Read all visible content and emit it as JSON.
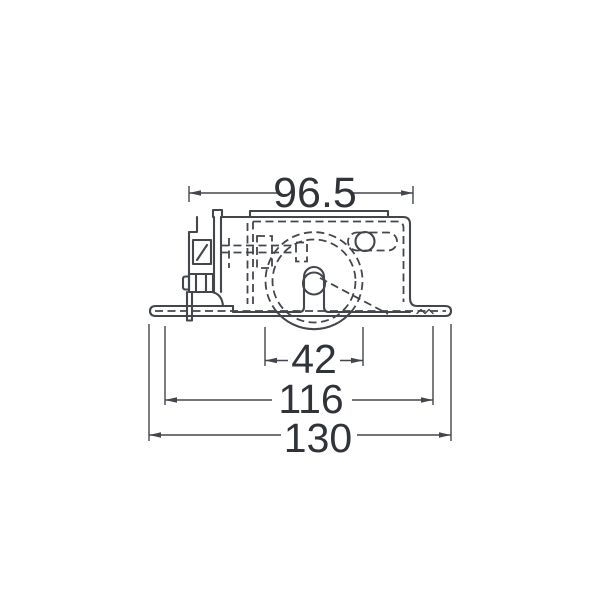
{
  "meta": {
    "description": "technical-dimension-drawing",
    "background": "#ffffff",
    "line_color": "#43474c",
    "text_color": "#303438"
  },
  "drawing": {
    "view": "front-elevation-of-bracket-mounted-roller",
    "dimensions": {
      "top_width": "96.5",
      "wheel_diameter": "42",
      "inner_width": "116",
      "overall_width": "130"
    }
  }
}
